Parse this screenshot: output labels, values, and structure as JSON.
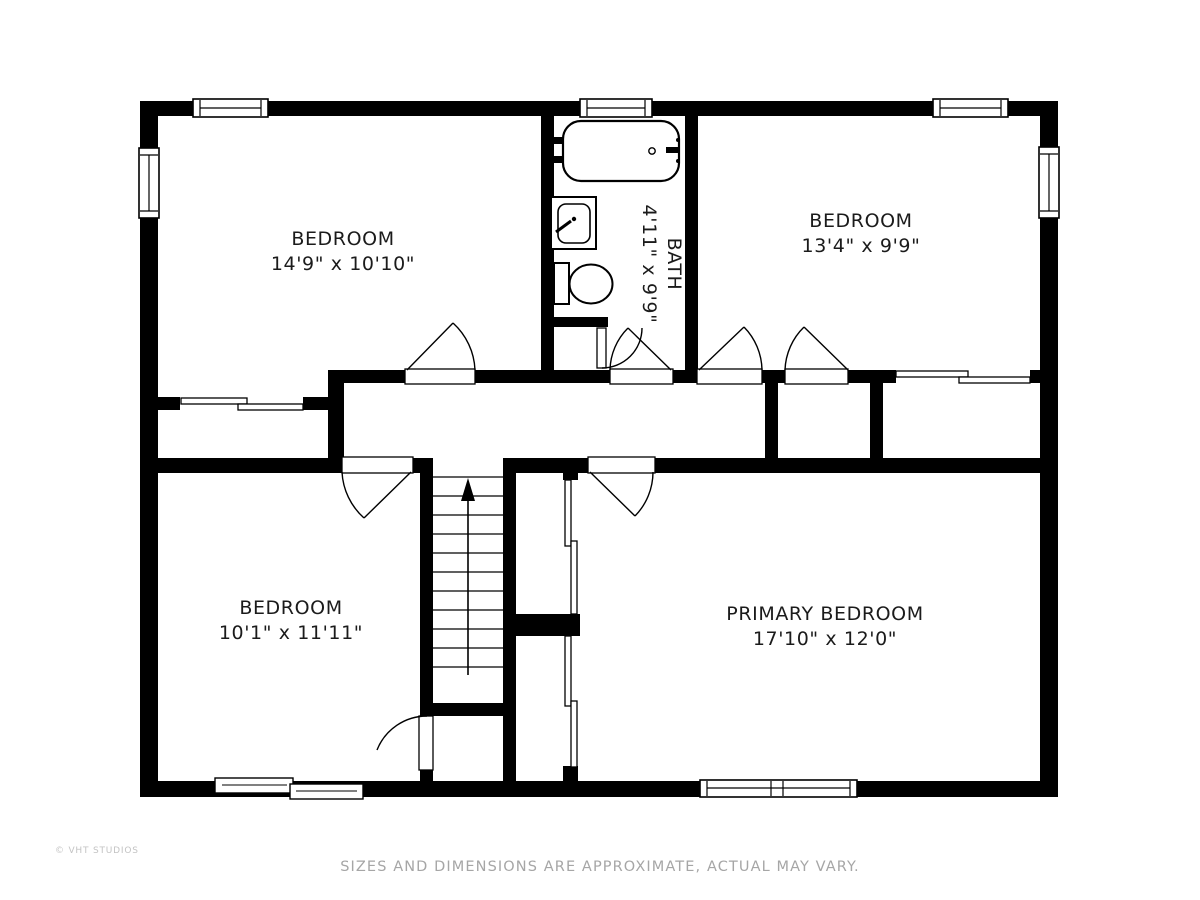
{
  "plan": {
    "type": "floor-plan",
    "rooms": [
      {
        "name": "BEDROOM",
        "dims": "14'9\" x 10'10\"",
        "position": "top-left"
      },
      {
        "name": "BEDROOM",
        "dims": "13'4\" x 9'9\"",
        "position": "top-right"
      },
      {
        "name": "BATH",
        "dims": "4'11\" x 9'9\"",
        "position": "top-center",
        "label_rotated": true
      },
      {
        "name": "BEDROOM",
        "dims": "10'1\" x 11'11\"",
        "position": "bottom-left"
      },
      {
        "name": "PRIMARY BEDROOM",
        "dims": "17'10\" x 12'0\"",
        "position": "bottom-right"
      }
    ],
    "fixtures": [
      "bathtub",
      "sink",
      "toilet",
      "staircase-up"
    ],
    "colors": {
      "wall": "#000000",
      "floor": "#ffffff",
      "label": "#1b1b1b",
      "disclaimer": "#a6a6a6",
      "watermark": "#c3c3c3"
    }
  },
  "footer": {
    "disclaimer": "SIZES AND DIMENSIONS ARE APPROXIMATE, ACTUAL MAY VARY.",
    "watermark": "© VHT STUDIOS"
  }
}
